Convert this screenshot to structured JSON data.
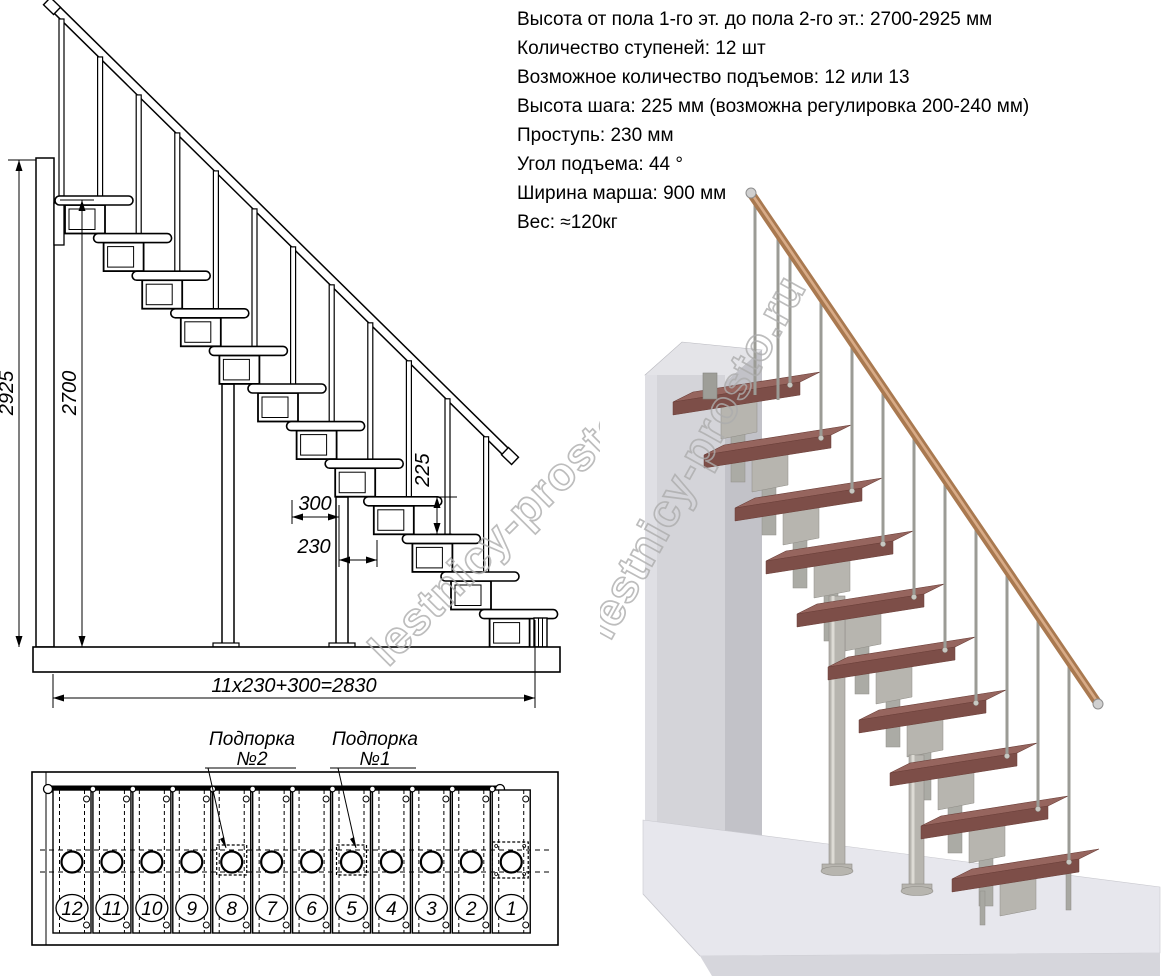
{
  "specs": {
    "lines": [
      "Высота от пола 1-го эт. до пола 2-го эт.: 2700-2925 мм",
      "Количество ступеней: 12 шт",
      "Возможное количество подъемов: 12 или 13",
      "Высота шага: 225 мм (возможна регулировка 200-240 мм)",
      "Проступь: 230 мм",
      "Угол подъема: 44 °",
      "Ширина марша: 900 мм",
      "Вес: ≈120кг"
    ]
  },
  "elevation": {
    "step_count": 12,
    "dim_total_height": "2925",
    "dim_flight_height": "2700",
    "dim_platform_depth": "300",
    "dim_tread_depth": "230",
    "dim_step_rise": "225",
    "dim_total_length": "11x230+300=2830"
  },
  "plan": {
    "support_2_label": [
      "Подпорка",
      "№2"
    ],
    "support_1_label": [
      "Подпорка",
      "№1"
    ],
    "step_numbers": [
      "12",
      "11",
      "10",
      "9",
      "8",
      "7",
      "6",
      "5",
      "4",
      "3",
      "2",
      "1"
    ]
  },
  "render3d": {
    "step_count": 10
  },
  "watermark": {
    "text": "lestnicy-prosto.ru"
  },
  "colors": {
    "line": "#000000",
    "watermark": "#adadad",
    "wood_top": "#96655e",
    "wood_front": "#7d4e48",
    "wood_edge": "#6b3f39",
    "metal": "#b7b5af",
    "metal_dark": "#8f8d87",
    "metal_light": "#dddbd5",
    "rail": "#a97950",
    "rail_highlight": "#d8ab87",
    "wall_front": "#d4d4d9",
    "wall_side": "#c2c2c8",
    "wall_top": "#e4e4e8",
    "floor_top": "#e7e7ed",
    "floor_front": "#d6d6dc"
  }
}
